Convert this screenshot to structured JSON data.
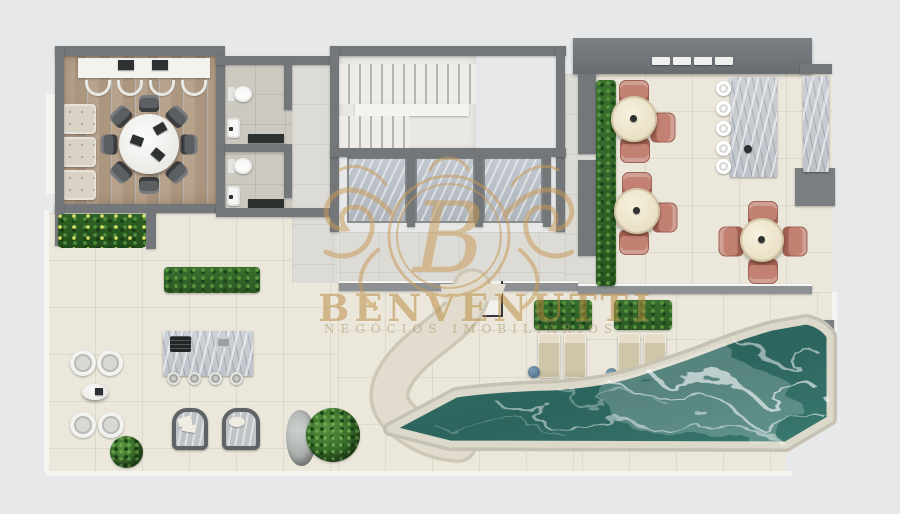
{
  "watermark": {
    "monogram": "B",
    "brand": "BENVENUTTI",
    "tagline": "NEGÓCIOS IMOBILIÁRIOS",
    "color": "#c89a55"
  },
  "palette": {
    "background": "#e7e8e9",
    "wall": "#73777a",
    "wall-light": "#8d9193",
    "deck": "#ebe7db",
    "wood": "#b3a08b",
    "tile": "#dcdbd6",
    "bath": "#ccc9c1",
    "pool-water": "#2f6b64",
    "pool-edge": "#d7d3c5",
    "terracotta": "#c28172",
    "cream": "#eee6cf",
    "green": "#3a7230",
    "lounger": "#cfc5ab",
    "pouf": "#5d82a0",
    "marble": "#c9cdd2",
    "white-f": "#f2f3f2",
    "gold": "#c89a55"
  },
  "scene": {
    "type": "top-down residential floor plan render — rooftop leisure level",
    "rooms": [
      {
        "name": "gourmet-room",
        "floor": "wood planks",
        "furniture": "round white table with 8 dark chairs, top counter with 4 stools, bench with 3 cushions"
      },
      {
        "name": "bathrooms",
        "count": 2,
        "fixtures": "toilet, sink and dark counter each"
      },
      {
        "name": "stair-core",
        "features": "staircase with landing and 3 marble elevator cabins"
      },
      {
        "name": "terrace",
        "furniture": "2 cream tables with 3 terracotta chairs each, marble bar with 5 white stools, wall counter"
      },
      {
        "name": "corner-dining",
        "furniture": "cream table with 4 terracotta chairs"
      },
      {
        "name": "barbecue-area",
        "furniture": "marble grill island with 4 stools, 2 wicker armchairs, 4 white chairs with side table"
      },
      {
        "name": "pool-deck",
        "furniture": "4 sun loungers, 2 planters, 4 blue poufs"
      },
      {
        "name": "pool",
        "shape": "angular pool with pointed west end and marble-veined water"
      }
    ],
    "plants": "tropical planter, hedge planters, round bushes, rock garden"
  }
}
